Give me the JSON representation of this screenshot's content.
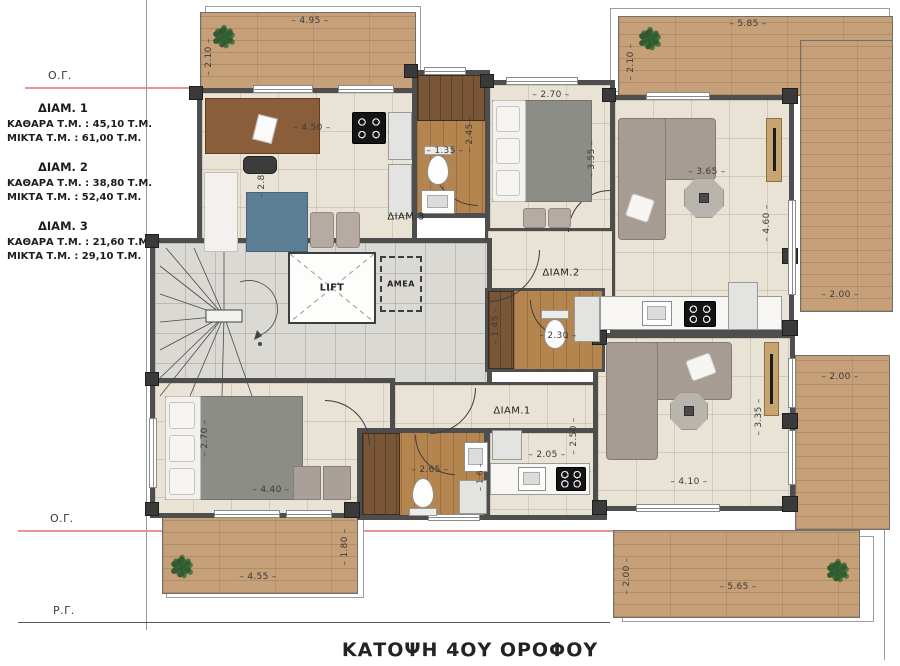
{
  "title": "ΚΑΤΟΨΗ 4ΟΥ ΟΡΟΦΟΥ",
  "annotations": {
    "og_top": "Ο.Γ.",
    "og_bottom": "Ο.Γ.",
    "rg": "Ρ.Γ."
  },
  "legend": {
    "apartments": [
      {
        "name": "ΔΙΑΜ. 1",
        "net": "ΚΑΘΑΡΑ Τ.Μ. : 45,10 Τ.Μ.",
        "gross": "ΜΙΚΤΑ Τ.Μ. : 61,00 Τ.Μ."
      },
      {
        "name": "ΔΙΑΜ. 2",
        "net": "ΚΑΘΑΡΑ Τ.Μ. : 38,80 Τ.Μ.",
        "gross": "ΜΙΚΤΑ Τ.Μ. : 52,40 Τ.Μ."
      },
      {
        "name": "ΔΙΑΜ. 3",
        "net": "ΚΑΘΑΡΑ Τ.Μ. : 21,60 Τ.Μ.",
        "gross": "ΜΙΚΤΑ Τ.Μ. : 29,10 Τ.Μ."
      }
    ]
  },
  "rooms": {
    "diam1": "ΔΙΑΜ.1",
    "diam2": "ΔΙΑΜ.2",
    "diam3": "ΔΙΑΜ.3",
    "lift": "LIFT",
    "amea": "AMEA"
  },
  "dims": {
    "balcony_tl_w": "4.95",
    "balcony_tl_h": "2.10",
    "balcony_tr_w": "5.85",
    "balcony_tr_h": "2.10",
    "studio_w": "4.50",
    "studio_h": "2.80",
    "bath3_w": "1.35",
    "bath3_h": "2.45",
    "bed2_w": "2.70",
    "bed2_h": "3.55",
    "liv2_w": "3.65",
    "liv2_h": "4.60",
    "deck_right_top": "2.00",
    "bath2_h": "1.45",
    "bath2_w": "2.30",
    "bed1_h": "2.70",
    "bed1_w": "4.40",
    "bath1_w": "2.65",
    "bath1_h": "1.6",
    "kit1_w": "2.05",
    "kit1_h": "2.50",
    "liv1_w": "4.10",
    "liv1_h": "3.35",
    "deck_right_bottom": "2.00",
    "balcony_bl_w": "4.55",
    "balcony_bl_h": "1.80",
    "balcony_br_w": "5.65",
    "balcony_br_h": "2.00"
  },
  "icons": {
    "plant": "✽"
  },
  "colors": {
    "deck_wood": "#c6a078",
    "floor_beige": "#e9e3d5",
    "hall_gray": "#dbd9d3",
    "bath_wood": "#b5854f",
    "wall_gray": "#4e4e4e",
    "regulation_line_red": "#e89494",
    "accent_blue": "#5d7f96",
    "sofa_gray": "#a79c93"
  }
}
